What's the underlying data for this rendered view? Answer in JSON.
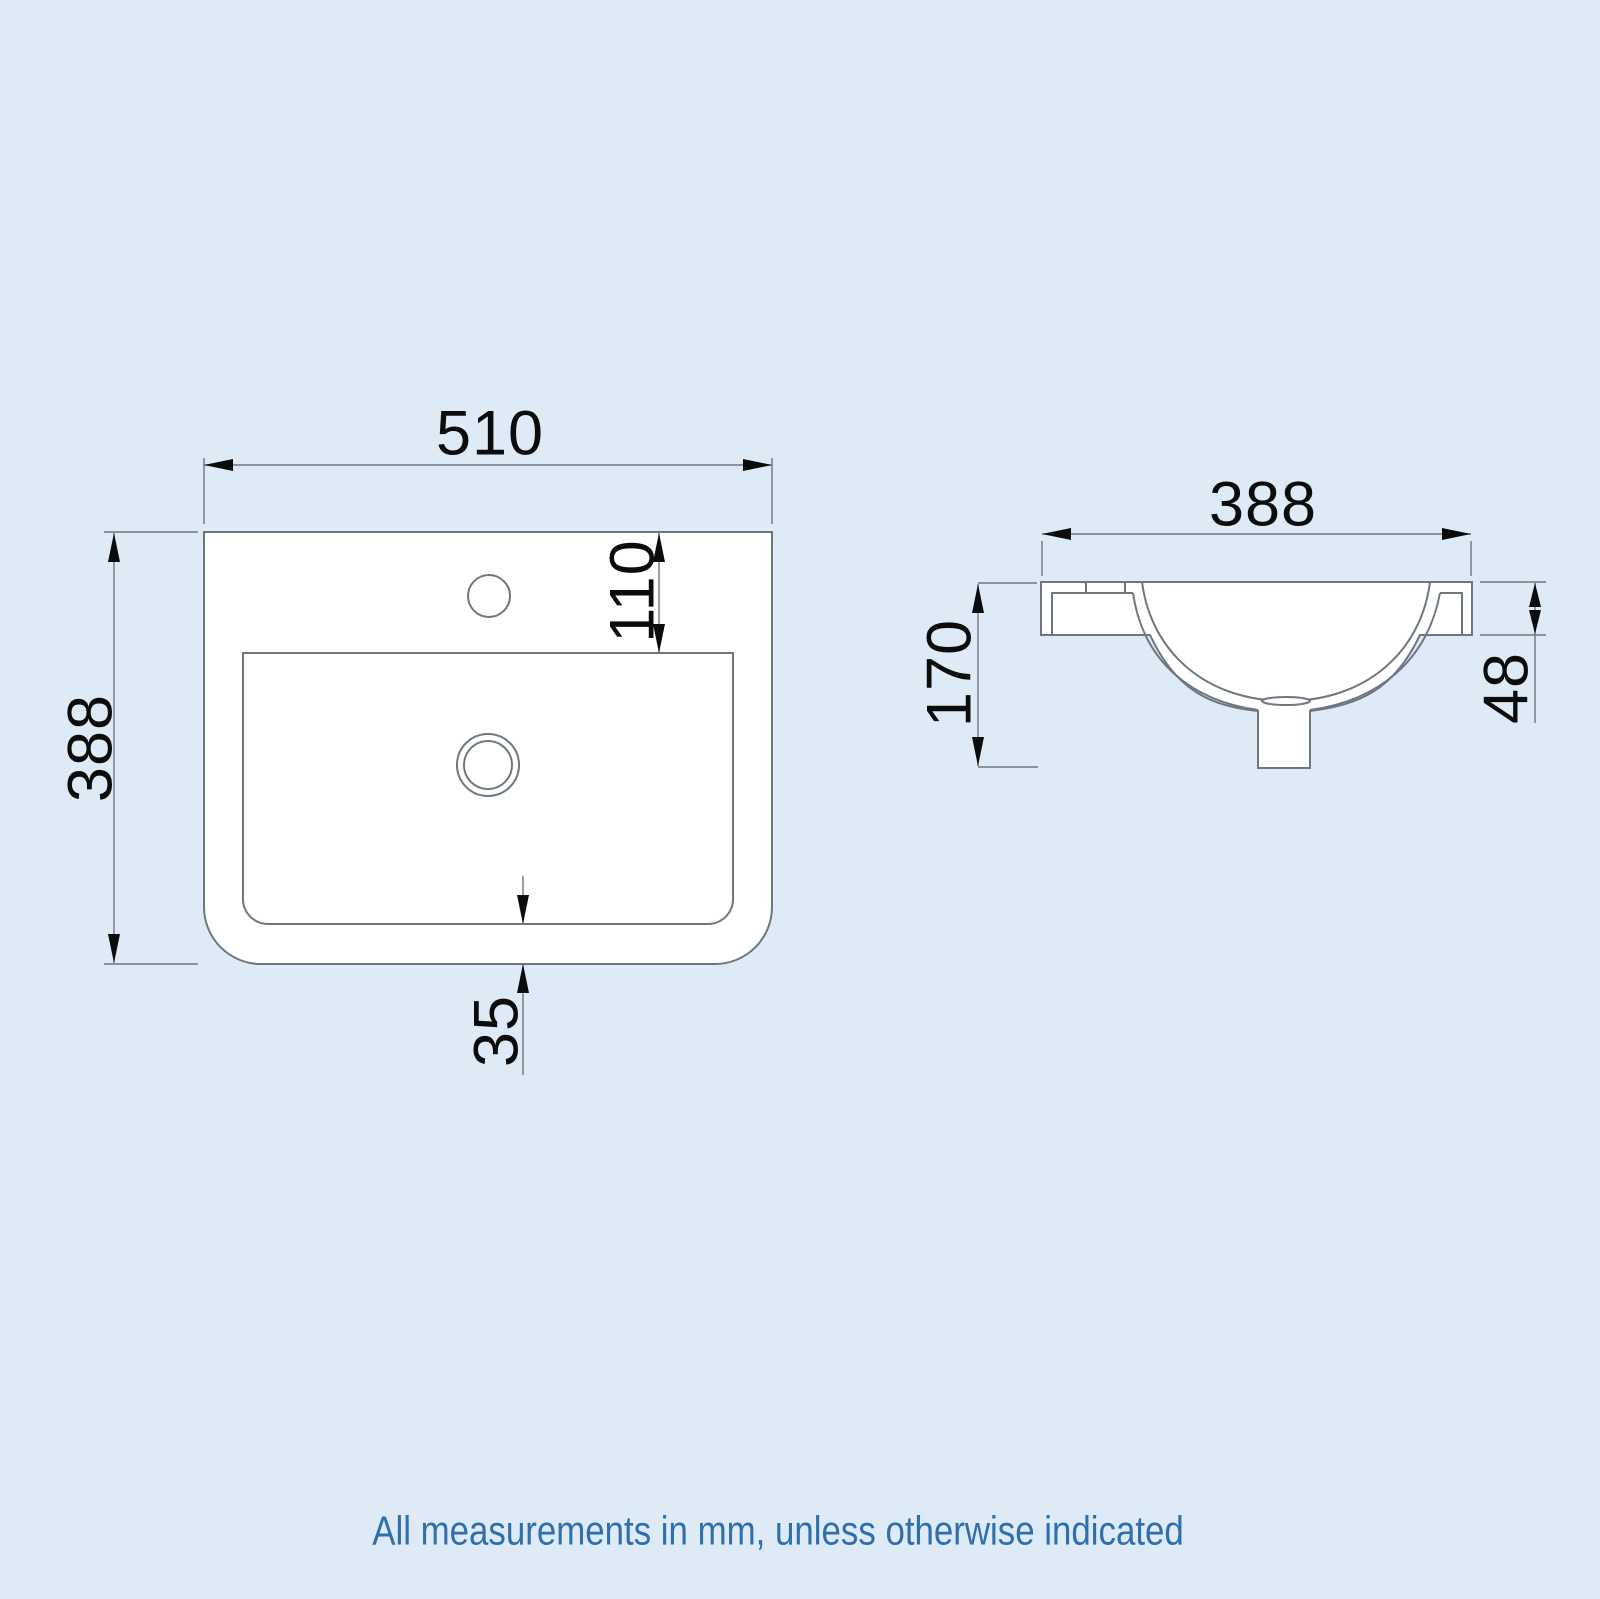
{
  "page": {
    "background": "#dfeaf7",
    "line_color": "#6e7680",
    "dim_text_color": "#0c0c0c"
  },
  "drawing": {
    "title": "basin-technical-drawing",
    "plan_view": {
      "name": "basin-plan-view",
      "dims": {
        "overall_width_mm": "510",
        "overall_depth_mm": "388",
        "tap_hole_offset_mm": "110",
        "front_lip_mm": "35"
      }
    },
    "side_view": {
      "name": "basin-side-view",
      "dims": {
        "overall_width_mm": "388",
        "overall_height_mm": "170",
        "rim_edge_mm": "48"
      }
    }
  },
  "footer": {
    "note": "All measurements in mm, unless otherwise indicated",
    "color": "#2e6fad"
  }
}
